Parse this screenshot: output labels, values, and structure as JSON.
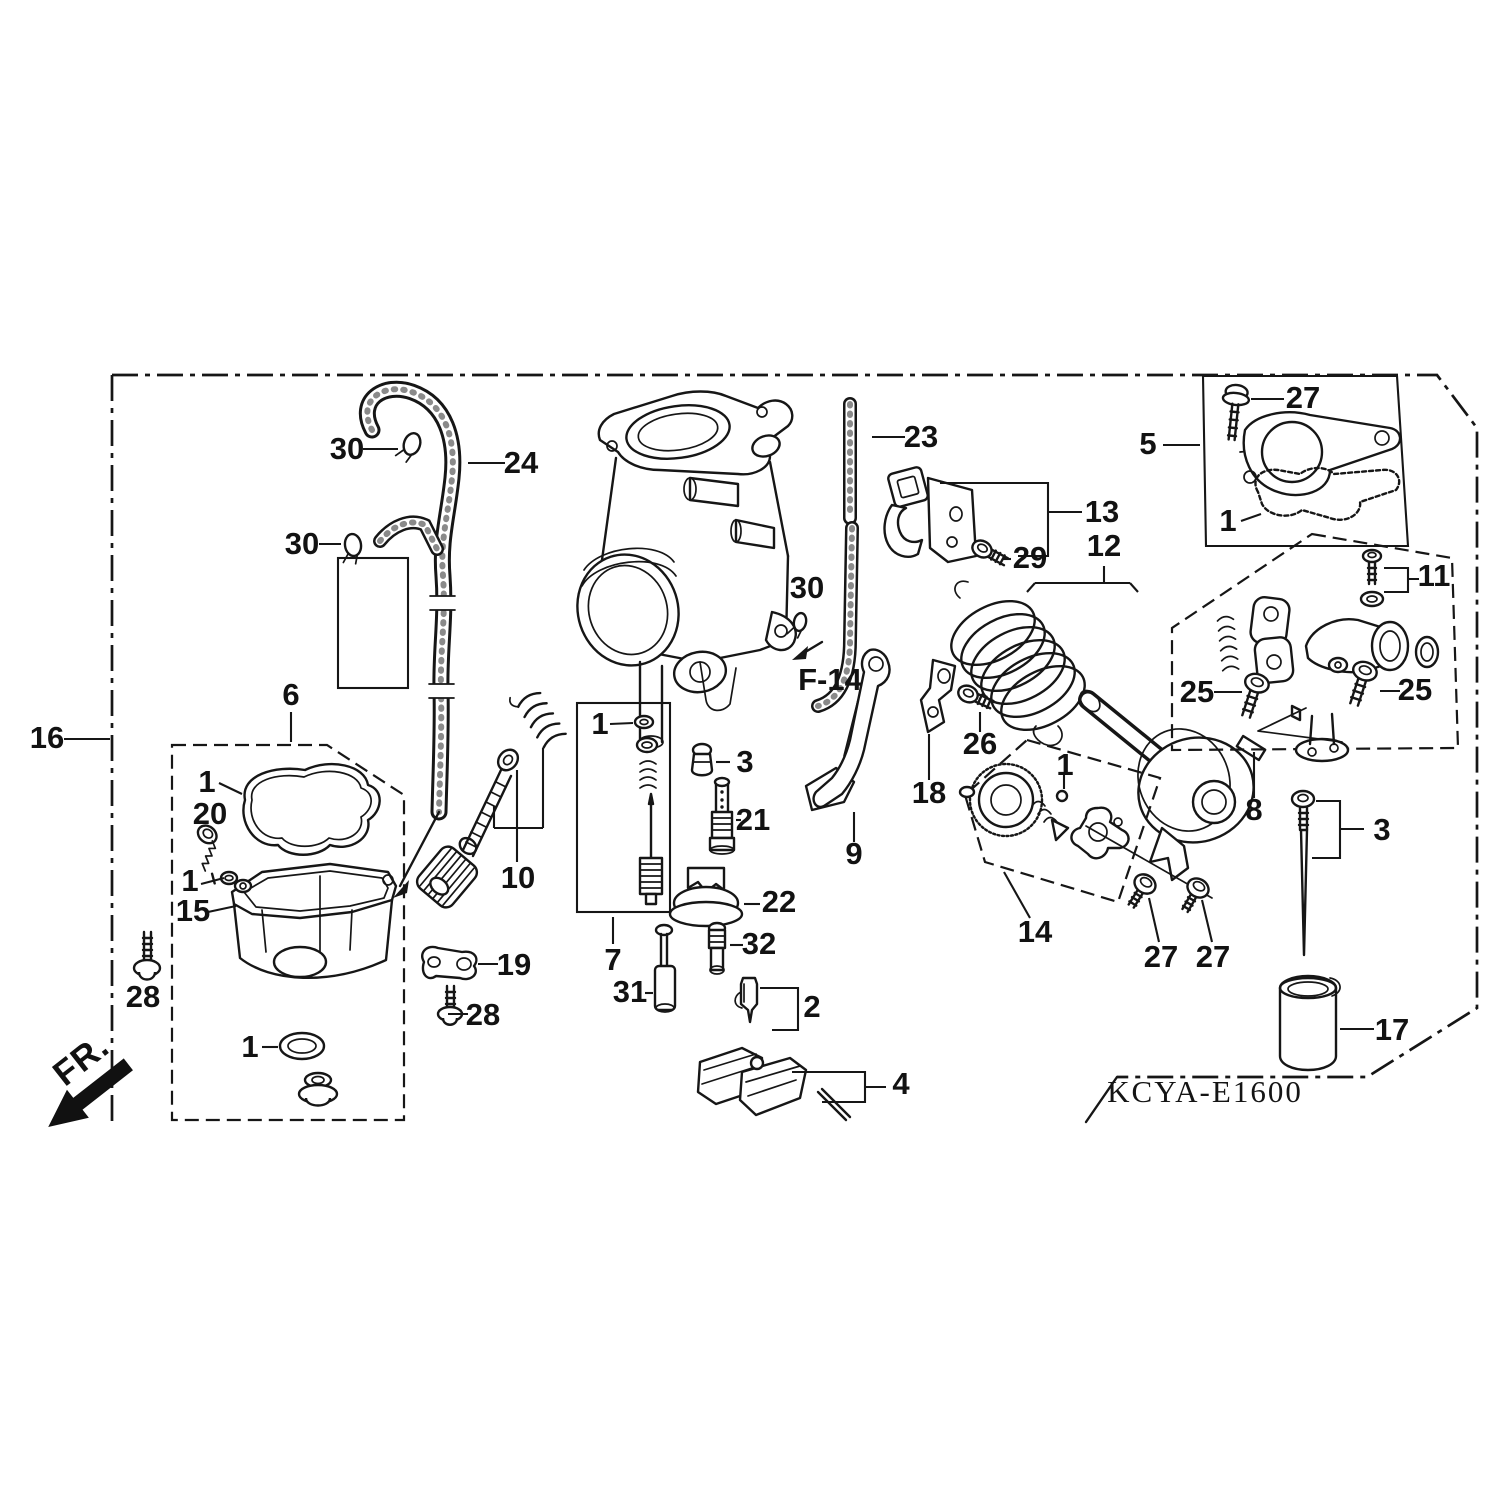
{
  "diagram_code": "KCYA-E1600",
  "figure_reference": "F-14",
  "orientation_label": "FR.",
  "ink_color": "#161616",
  "background_color": "#ffffff",
  "callouts": [
    {
      "ref": "16",
      "area": "left-frame-border"
    },
    {
      "ref": "30",
      "area": "hose-upper-clip"
    },
    {
      "ref": "24",
      "area": "fuel-hose"
    },
    {
      "ref": "30",
      "area": "hose-lower-clip"
    },
    {
      "ref": "6",
      "area": "float-chamber-group"
    },
    {
      "ref": "1",
      "area": "chamber-gasket"
    },
    {
      "ref": "20",
      "area": "chamber-screw"
    },
    {
      "ref": "1",
      "area": "screw-washer"
    },
    {
      "ref": "15",
      "area": "float-chamber-body"
    },
    {
      "ref": "28",
      "area": "drain-screw-left"
    },
    {
      "ref": "1",
      "area": "drain-o-ring"
    },
    {
      "ref": "19",
      "area": "clamp-bracket"
    },
    {
      "ref": "28",
      "area": "bracket-screw"
    },
    {
      "ref": "10",
      "area": "air-screw-set"
    },
    {
      "ref": "7",
      "area": "jet-needle-set"
    },
    {
      "ref": "1",
      "area": "needle-set-washer"
    },
    {
      "ref": "3",
      "area": "center-cap"
    },
    {
      "ref": "21",
      "area": "main-jet"
    },
    {
      "ref": "22",
      "area": "diffuser"
    },
    {
      "ref": "32",
      "area": "slow-jet"
    },
    {
      "ref": "31",
      "area": "plunger"
    },
    {
      "ref": "2",
      "area": "float-valve"
    },
    {
      "ref": "4",
      "area": "float-set"
    },
    {
      "ref": "23",
      "area": "overflow-tube"
    },
    {
      "ref": "13",
      "area": "cable-bracket-assembly"
    },
    {
      "ref": "29",
      "area": "cable-bracket-screw"
    },
    {
      "ref": "30",
      "area": "tube-clip-near-f14"
    },
    {
      "ref": "12",
      "area": "choke-spring-drum"
    },
    {
      "ref": "9",
      "area": "throttle-lever"
    },
    {
      "ref": "18",
      "area": "joint-bracket"
    },
    {
      "ref": "26",
      "area": "joint-screw"
    },
    {
      "ref": "5",
      "area": "top-cover-set"
    },
    {
      "ref": "27",
      "area": "cover-screw"
    },
    {
      "ref": "1",
      "area": "cover-gasket"
    },
    {
      "ref": "11",
      "area": "link-screw-washer"
    },
    {
      "ref": "25",
      "area": "link-screw-left"
    },
    {
      "ref": "25",
      "area": "link-screw-right"
    },
    {
      "ref": "8",
      "area": "link-arm-group"
    },
    {
      "ref": "1",
      "area": "pump-ball"
    },
    {
      "ref": "14",
      "area": "pump-assembly"
    },
    {
      "ref": "27",
      "area": "pump-screw-left"
    },
    {
      "ref": "27",
      "area": "pump-screw-right"
    },
    {
      "ref": "3",
      "area": "needle-set-right"
    },
    {
      "ref": "17",
      "area": "needle-cup"
    }
  ]
}
